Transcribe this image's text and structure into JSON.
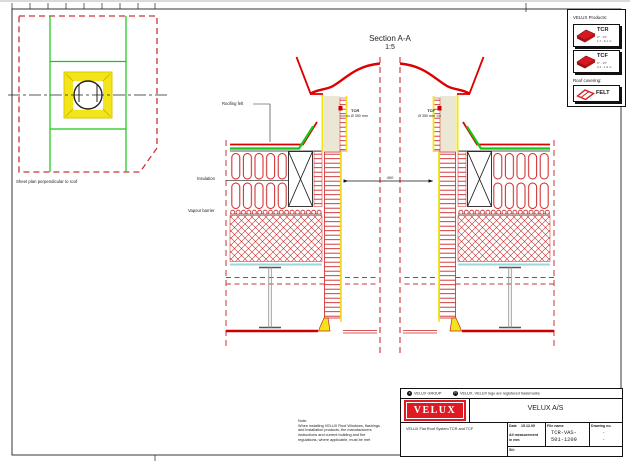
{
  "plan": {
    "caption": "Sheet plan perpendicular to roof"
  },
  "section": {
    "title": "Section A-A",
    "scale": "1:5",
    "labels": {
      "roofing_felt": "Roofing felt",
      "insulation": "Insulation",
      "vapour_barrier": "Vapour barrier",
      "tcr_code": "TCR",
      "tcr_dia": "Ø 350 mm",
      "tcf_code": "TCF",
      "tcf_dia": "Ø 350 mm",
      "dim_width": "400"
    }
  },
  "legend": {
    "title": "VELUX Products:",
    "products": [
      {
        "code": "TCR",
        "sub1": "0° - 15°",
        "sub2": "1.7 - 6.1 m"
      },
      {
        "code": "TCF",
        "sub1": "0° - 15°",
        "sub2": "0.4 - 1.9 m"
      }
    ],
    "roof_covering_title": "Roof covering:",
    "covering_code": "FELT"
  },
  "titleblock": {
    "copyright_mark": "c",
    "copyright_text": "VELUX GROUP",
    "registered_mark": "R",
    "trademark_text": "VELUX, VELUX logo are registered trademarks",
    "logo_text": "VELUX",
    "company": "VELUX A/S",
    "description": "VELUX Flat Roof System TCR and TCF",
    "date_label": "Date",
    "date_value": "15.12.09",
    "measurement_note1": "All measurement",
    "measurement_note2": "in mm",
    "file_label": "File name",
    "file_line1": "TCR-VAS-",
    "file_line2": "501-1209",
    "drawing_label": "Drawing no.",
    "drawing_line1": "-",
    "drawing_line2": "-",
    "path_label": "Sti:"
  },
  "note": {
    "title": "Note:",
    "lines": [
      "When installing VELUX Roof Windows, flashings",
      "and installation products, the manufacturers",
      "instructions and current building and fire",
      "regulations, where applicable, must be met"
    ]
  },
  "colors": {
    "velux_red": "#e01a22",
    "line_red": "#cc2222",
    "bright_red": "#dd0000",
    "green": "#16c616",
    "yellow": "#f3e51a",
    "cyan": "#9fd6dd"
  }
}
